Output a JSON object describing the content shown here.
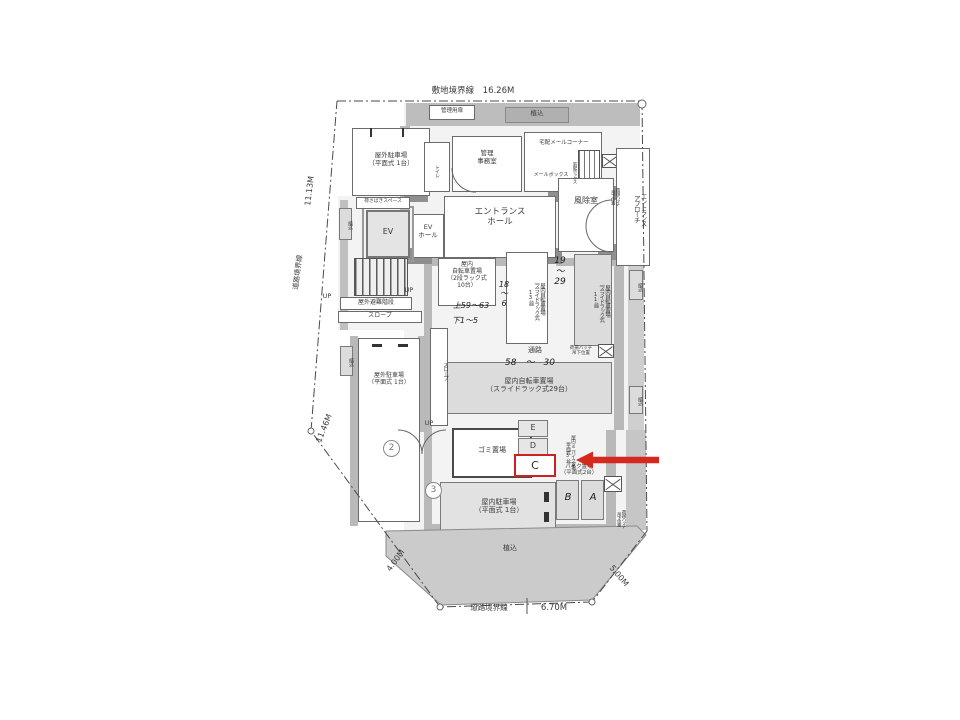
{
  "annotation": {
    "highlight_label": "C",
    "arrow_color": "#d7281d",
    "box_color": "#cc2222"
  },
  "labels": [
    {
      "n": "dim-site-boundary-top",
      "t": "敷地境界線　16.26M",
      "x": 408,
      "y": 86,
      "w": 130,
      "fs": 8.5
    },
    {
      "n": "label-mgmt-door",
      "t": "管理用扉",
      "x": 431,
      "y": 108,
      "w": 42,
      "fs": 5.5
    },
    {
      "n": "label-planting-top",
      "t": "植込",
      "x": 505,
      "y": 110,
      "w": 64,
      "fs": 6.5
    },
    {
      "n": "room-outdoor-parking-nw",
      "t": "屋外駐車場\n（平面式 1台）",
      "x": 356,
      "y": 152,
      "w": 70,
      "fs": 6.5
    },
    {
      "n": "room-office",
      "t": "管理\n事務室",
      "x": 462,
      "y": 150,
      "w": 50,
      "fs": 6.5
    },
    {
      "n": "label-delivery-corner",
      "t": "宅配メールコーナー",
      "x": 524,
      "y": 140,
      "w": 80,
      "fs": 5.5
    },
    {
      "n": "label-mailbox",
      "t": "メールボックス",
      "x": 524,
      "y": 173,
      "w": 54,
      "fs": 5
    },
    {
      "n": "label-delivery-box",
      "t": "宅配ボックス",
      "x": 562,
      "y": 153,
      "w": 14,
      "h": 38,
      "fs": 4.5,
      "v": 1
    },
    {
      "n": "label-toilet",
      "t": "トイレ",
      "x": 427,
      "y": 156,
      "w": 12,
      "h": 30,
      "fs": 5,
      "v": 1
    },
    {
      "n": "label-hatch-top",
      "t": "荷揚ハッチ\n吊下位置",
      "x": 601,
      "y": 174,
      "w": 18,
      "h": 46,
      "fs": 4.5,
      "v": 1
    },
    {
      "n": "room-entrance-hall",
      "t": "エントランス\nホール",
      "x": 452,
      "y": 207,
      "w": 96,
      "fs": 8.5
    },
    {
      "n": "room-ev-hall",
      "t": "EV\nホール",
      "x": 413,
      "y": 224,
      "w": 30,
      "fs": 6.5
    },
    {
      "n": "room-ev",
      "t": "EV",
      "x": 372,
      "y": 227,
      "w": 32,
      "fs": 8
    },
    {
      "n": "room-windbreak",
      "t": "風除室",
      "x": 562,
      "y": 196,
      "w": 48,
      "fs": 8
    },
    {
      "n": "label-entrance-approach",
      "t": "エントランス\nアプローチ",
      "x": 619,
      "y": 158,
      "w": 27,
      "h": 102,
      "fs": 6.5,
      "v": 1
    },
    {
      "n": "label-loading-space",
      "t": "荷さばきスペース",
      "x": 357,
      "y": 199,
      "w": 52,
      "fs": 4.8
    },
    {
      "n": "dim-11-13",
      "t": "11.13M",
      "x": 307,
      "y": 208,
      "w": 44,
      "fs": 8,
      "r": -83
    },
    {
      "n": "label-road-boundary-left",
      "t": "道路境界線",
      "x": 295,
      "y": 292,
      "w": 48,
      "fs": 7,
      "r": -83
    },
    {
      "n": "label-planting-left-up",
      "t": "植込",
      "x": 340,
      "y": 211,
      "w": 12,
      "h": 28,
      "fs": 5,
      "v": 1
    },
    {
      "n": "label-evac-stairs",
      "t": "屋外避難階段",
      "x": 341,
      "y": 299,
      "w": 70,
      "fs": 6
    },
    {
      "n": "label-slope-h",
      "t": "スロープ",
      "x": 350,
      "y": 312,
      "w": 60,
      "fs": 6
    },
    {
      "n": "label-up-1",
      "t": "UP",
      "x": 318,
      "y": 293,
      "w": 18,
      "fs": 6.5
    },
    {
      "n": "label-up-2",
      "t": "UP",
      "x": 400,
      "y": 287,
      "w": 18,
      "fs": 6.5
    },
    {
      "n": "room-bike-rack10",
      "t": "屋内\n自転車置場\n（2段ラック式\n10台）",
      "x": 440,
      "y": 261,
      "w": 54,
      "fs": 6
    },
    {
      "n": "hand-upper-59-63",
      "t": "上59〜63",
      "x": 444,
      "y": 301,
      "w": 54,
      "fs": 8,
      "cls": "hand"
    },
    {
      "n": "hand-lower-1-5",
      "t": "下1〜5",
      "x": 442,
      "y": 316,
      "w": 46,
      "fs": 8,
      "cls": "hand"
    },
    {
      "n": "room-bike-rack13",
      "t": "屋内自転車置場\n（スライドラック式\n13台）",
      "x": 510,
      "y": 257,
      "w": 34,
      "h": 84,
      "fs": 5.5,
      "v": 1
    },
    {
      "n": "hand-18-6",
      "t": "18\n〜\n6",
      "x": 495,
      "y": 280,
      "w": 18,
      "fs": 8,
      "cls": "hand"
    },
    {
      "n": "hand-19-29",
      "t": "19\n〜\n29",
      "x": 549,
      "y": 256,
      "w": 22,
      "fs": 9,
      "cls": "hand"
    },
    {
      "n": "room-bike-rack11",
      "t": "屋内自転車置場\n（スライドラック式\n11台）",
      "x": 577,
      "y": 259,
      "w": 32,
      "h": 84,
      "fs": 5.5,
      "v": 1
    },
    {
      "n": "label-planting-right-1",
      "t": "植込",
      "x": 630,
      "y": 273,
      "w": 12,
      "h": 27,
      "fs": 5,
      "v": 1
    },
    {
      "n": "label-corridor",
      "t": "通路",
      "x": 515,
      "y": 346,
      "w": 40,
      "fs": 7
    },
    {
      "n": "hand-58-30",
      "t": "58　〜　30",
      "x": 492,
      "y": 358,
      "w": 76,
      "fs": 9,
      "cls": "hand"
    },
    {
      "n": "label-hatch-mid",
      "t": "荷揚ハッチ\n吊下位置",
      "x": 564,
      "y": 346,
      "w": 34,
      "fs": 4.5
    },
    {
      "n": "room-bike-rack29",
      "t": "屋内自転車置場\n（スライドラック式29台）",
      "x": 462,
      "y": 377,
      "w": 134,
      "fs": 7
    },
    {
      "n": "room-outdoor-parking-w",
      "t": "屋外駐車場\n（平面式 1台）",
      "x": 360,
      "y": 372,
      "w": 58,
      "fs": 6
    },
    {
      "n": "label-slope-v",
      "t": "スロープ",
      "x": 432,
      "y": 340,
      "w": 15,
      "h": 62,
      "fs": 5.5,
      "v": 1
    },
    {
      "n": "label-planting-left-mid",
      "t": "植込",
      "x": 341,
      "y": 348,
      "w": 12,
      "h": 27,
      "fs": 5,
      "v": 1
    },
    {
      "n": "dim-11-46",
      "t": "11.46M",
      "x": 316,
      "y": 444,
      "w": 44,
      "fs": 8,
      "r": -68
    },
    {
      "n": "marker-2",
      "t": "2",
      "x": 383,
      "y": 440,
      "fs": 9,
      "cls": "circ"
    },
    {
      "n": "marker-3",
      "t": "3",
      "x": 425,
      "y": 482,
      "fs": 9,
      "cls": "circ"
    },
    {
      "n": "label-up-3",
      "t": "UP",
      "x": 420,
      "y": 420,
      "w": 18,
      "fs": 6.5
    },
    {
      "n": "room-garbage",
      "t": "ゴミ置場",
      "x": 460,
      "y": 446,
      "w": 64,
      "fs": 7
    },
    {
      "n": "cell-E",
      "t": "E",
      "x": 520,
      "y": 423,
      "w": 26,
      "fs": 8
    },
    {
      "n": "cell-D",
      "t": "D",
      "x": 520,
      "y": 441,
      "w": 26,
      "fs": 8
    },
    {
      "n": "label-minibike",
      "t": "屋内ミニバイク置場\n（平面式3台）",
      "x": 551,
      "y": 416,
      "w": 24,
      "h": 72,
      "fs": 4.8,
      "v": 1
    },
    {
      "n": "label-bike-parking",
      "t": "バイク置場\n（平面式2台）",
      "x": 550,
      "y": 464,
      "w": 58,
      "fs": 5.5
    },
    {
      "n": "cell-B",
      "t": "B",
      "x": 558,
      "y": 492,
      "w": 20,
      "fs": 10,
      "cls": "hand"
    },
    {
      "n": "cell-A",
      "t": "A",
      "x": 583,
      "y": 492,
      "w": 20,
      "fs": 10,
      "cls": "hand"
    },
    {
      "n": "label-hatch-bottom",
      "t": "荷揚ハッチ\n吊下位置",
      "x": 608,
      "y": 498,
      "w": 17,
      "h": 42,
      "fs": 4.5,
      "v": 1
    },
    {
      "n": "room-indoor-parking",
      "t": "屋内駐車場\n（平面式 1台）",
      "x": 458,
      "y": 498,
      "w": 82,
      "fs": 7
    },
    {
      "n": "label-planting-right-2",
      "t": "植込",
      "x": 630,
      "y": 388,
      "w": 12,
      "h": 26,
      "fs": 5,
      "v": 1
    },
    {
      "n": "label-planting-bottom",
      "t": "植込",
      "x": 490,
      "y": 544,
      "w": 40,
      "fs": 7
    },
    {
      "n": "dim-4-00",
      "t": "4.00M",
      "x": 384,
      "y": 572,
      "w": 40,
      "fs": 8,
      "r": -54
    },
    {
      "n": "dim-5-00",
      "t": "5.00M",
      "x": 606,
      "y": 556,
      "w": 40,
      "fs": 8,
      "r": 50
    },
    {
      "n": "label-road-boundary-bottom",
      "t": "道路境界線",
      "x": 460,
      "y": 604,
      "w": 58,
      "fs": 7.5
    },
    {
      "n": "dim-6-70",
      "t": "6.70M",
      "x": 532,
      "y": 603,
      "w": 44,
      "fs": 8.5
    }
  ]
}
